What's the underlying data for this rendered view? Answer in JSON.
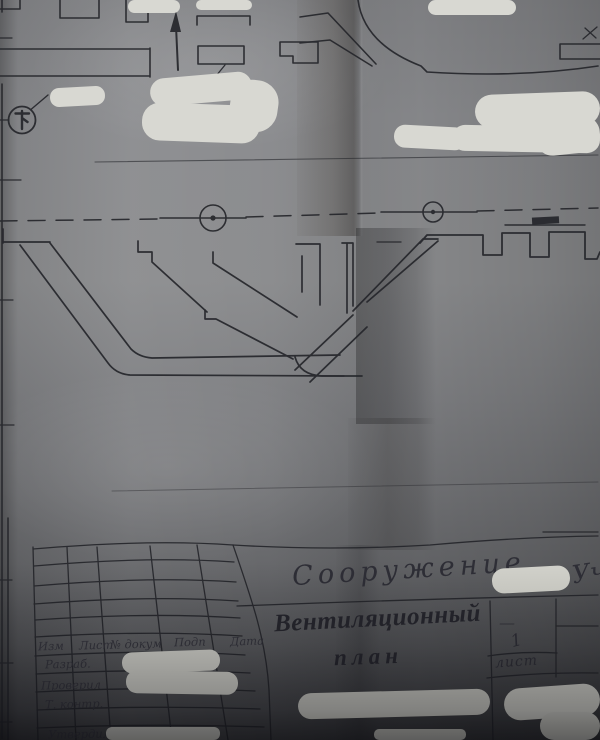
{
  "drawing": {
    "stamp": {
      "structure_label": "Сооружение",
      "structure_suffix": "Уч",
      "title_line1": "Вентиляционный",
      "title_line2": "план",
      "sheet_value": "1",
      "sheet_label": "лист",
      "empty_dash": "—"
    },
    "revision_table": {
      "header": [
        "Изм",
        "Лист",
        "№ докум",
        "Подп",
        "Дата"
      ],
      "rows": [
        {
          "label": "Разраб."
        },
        {
          "label": "Проверил"
        },
        {
          "label": "Т. контр."
        },
        {
          "label": ""
        },
        {
          "label": "Утвердил"
        }
      ]
    },
    "icons": {
      "north_arrow": "↑",
      "survey_point": "⊕",
      "equipment_tag": "Ŧ"
    },
    "colors": {
      "paper_light": "#8b8c8e",
      "paper_dark": "#4b4c4f",
      "ink": "#25262b",
      "redaction": "#d7d7d1"
    }
  }
}
